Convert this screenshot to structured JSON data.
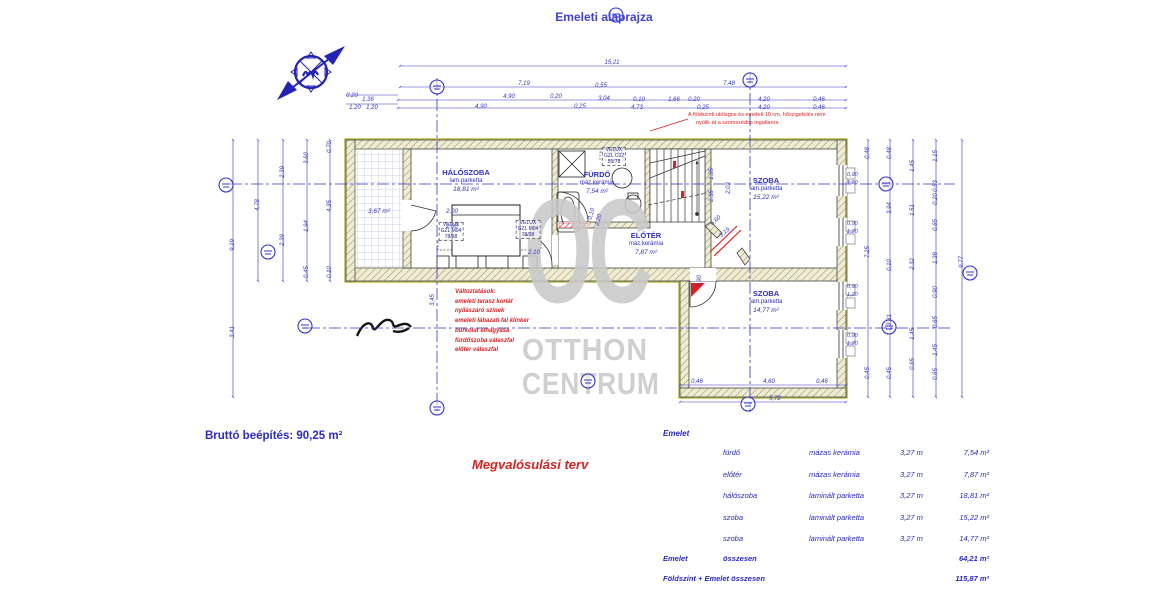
{
  "title": "Emeleti alaprajza",
  "gross_area_label": "Bruttó beépítés: 90,25 m²",
  "plan_type_label": "Megvalósulási terv",
  "insulation_note": [
    "A földszinti utólagos és emeleti 10 cm. hőszigetelés nem",
    "nyúlik át a szomszédos ingatlanra"
  ],
  "changes_note": [
    "Változtatások:",
    "emeleti terasz korlát",
    "nyílászáró színek",
    "emeleti lábazati fal klinker",
    "burkolat elhagyása",
    "fürdőszoba válaszfal",
    "előtér válaszfal"
  ],
  "watermark": {
    "monogram": "OC",
    "name_line1": "OTTHON",
    "name_line2": "CENTRUM"
  },
  "colors": {
    "annotation_blue": "#3434d0",
    "revision_red": "#e02020",
    "watermark_gray": "#c9c9c9",
    "wall_khaki": "#b9b93e"
  },
  "rooms": [
    {
      "name": "HÁLÓSZOBA",
      "floor": "lam.parketta",
      "area": "18,81 m²",
      "x": 466,
      "y": 168
    },
    {
      "name": "FÜRDŐ",
      "floor": "máz.kerámia",
      "area": "7,54 m²",
      "x": 597,
      "y": 170
    },
    {
      "name": "ELŐTÉR",
      "floor": "máz.kerámia",
      "area": "7,87 m²",
      "x": 646,
      "y": 231
    },
    {
      "name": "SZOBA",
      "floor": "lam.parketta",
      "area": "15,22 m²",
      "x": 766,
      "y": 176
    },
    {
      "name": "SZOBA",
      "floor": "lam.parketta",
      "area": "14,77 m²",
      "x": 766,
      "y": 289
    },
    {
      "name": "",
      "floor": "",
      "area": "3,67 m²",
      "x": 379,
      "y": 208
    }
  ],
  "velux": [
    {
      "lines": [
        "VELUX",
        "GZL M04",
        "78/98"
      ],
      "x": 451,
      "y": 222
    },
    {
      "lines": [
        "VELUX",
        "GZL M04",
        "78/98"
      ],
      "x": 528,
      "y": 220
    },
    {
      "lines": [
        "VELUX",
        "GZL C02",
        "55/78"
      ],
      "x": 614,
      "y": 147
    }
  ],
  "window_dims": [
    {
      "top": "0,90",
      "bottom": "1,20",
      "x": 847,
      "y": 172
    },
    {
      "top": "0,90",
      "bottom": "1,20",
      "x": 847,
      "y": 221
    },
    {
      "top": "0,90",
      "bottom": "1,20",
      "x": 847,
      "y": 284
    },
    {
      "top": "0,90",
      "bottom": "1,20",
      "x": 847,
      "y": 333
    }
  ],
  "dims": [
    {
      "t": "15,21",
      "x": 612,
      "y": 63
    },
    {
      "t": "7,19",
      "x": 524,
      "y": 84
    },
    {
      "t": "0,55",
      "x": 601,
      "y": 86
    },
    {
      "t": "7,48",
      "x": 729,
      "y": 84
    },
    {
      "t": "4,90",
      "x": 509,
      "y": 97
    },
    {
      "t": "0,20",
      "x": 556,
      "y": 97
    },
    {
      "t": "3,04",
      "x": 604,
      "y": 99
    },
    {
      "t": "0,10",
      "x": 639,
      "y": 100
    },
    {
      "t": "1,66",
      "x": 674,
      "y": 100
    },
    {
      "t": "0,20",
      "x": 694,
      "y": 100
    },
    {
      "t": "4,20",
      "x": 764,
      "y": 100
    },
    {
      "t": "0,46",
      "x": 819,
      "y": 100
    },
    {
      "t": "4,90",
      "x": 481,
      "y": 107
    },
    {
      "t": "0,25",
      "x": 580,
      "y": 107
    },
    {
      "t": "4,73",
      "x": 637,
      "y": 108
    },
    {
      "t": "0,25",
      "x": 703,
      "y": 108
    },
    {
      "t": "4,20",
      "x": 764,
      "y": 108
    },
    {
      "t": "0,46",
      "x": 819,
      "y": 108
    },
    {
      "t": "0,20",
      "x": 352,
      "y": 96
    },
    {
      "t": "1,36",
      "x": 368,
      "y": 100
    },
    {
      "t": "1,20",
      "x": 355,
      "y": 108
    },
    {
      "t": "1,20",
      "x": 372,
      "y": 108
    },
    {
      "t": "9,19",
      "x": 233,
      "y": 245,
      "r": -90
    },
    {
      "t": "3,41",
      "x": 233,
      "y": 332,
      "r": -90
    },
    {
      "t": "4,78",
      "x": 258,
      "y": 205,
      "r": -90
    },
    {
      "t": "2,39",
      "x": 283,
      "y": 172,
      "r": -90
    },
    {
      "t": "2,39",
      "x": 283,
      "y": 240,
      "r": -90
    },
    {
      "t": "3,60",
      "x": 307,
      "y": 158,
      "r": -90
    },
    {
      "t": "1,94",
      "x": 307,
      "y": 226,
      "r": -90
    },
    {
      "t": "0,45",
      "x": 307,
      "y": 272,
      "r": -90
    },
    {
      "t": "0,70",
      "x": 330,
      "y": 147,
      "r": -90
    },
    {
      "t": "4,35",
      "x": 330,
      "y": 206,
      "r": -90
    },
    {
      "t": "0,10",
      "x": 330,
      "y": 272,
      "r": -90
    },
    {
      "t": "0,48",
      "x": 868,
      "y": 153,
      "r": -90
    },
    {
      "t": "7,25",
      "x": 868,
      "y": 252,
      "r": -90
    },
    {
      "t": "0,45",
      "x": 868,
      "y": 373,
      "r": -90
    },
    {
      "t": "0,48",
      "x": 890,
      "y": 153,
      "r": -90
    },
    {
      "t": "3,94",
      "x": 890,
      "y": 208,
      "r": -90
    },
    {
      "t": "0,10",
      "x": 890,
      "y": 265,
      "r": -90
    },
    {
      "t": "3,31",
      "x": 890,
      "y": 320,
      "r": -90
    },
    {
      "t": "0,45",
      "x": 890,
      "y": 373,
      "r": -90
    },
    {
      "t": "1,45",
      "x": 913,
      "y": 166,
      "r": -90
    },
    {
      "t": "1,51",
      "x": 913,
      "y": 210,
      "r": -90
    },
    {
      "t": "2,32",
      "x": 913,
      "y": 264,
      "r": -90
    },
    {
      "t": "1,45",
      "x": 913,
      "y": 334,
      "r": -90
    },
    {
      "t": "0,65",
      "x": 913,
      "y": 364,
      "r": -90
    },
    {
      "t": "1,15",
      "x": 936,
      "y": 156,
      "r": -90
    },
    {
      "t": "0,53",
      "x": 936,
      "y": 186,
      "r": -90
    },
    {
      "t": "0,20",
      "x": 936,
      "y": 199,
      "r": -90
    },
    {
      "t": "0,65",
      "x": 936,
      "y": 225,
      "r": -90
    },
    {
      "t": "1,38",
      "x": 936,
      "y": 258,
      "r": -90
    },
    {
      "t": "0,90",
      "x": 936,
      "y": 292,
      "r": -90
    },
    {
      "t": "0,65",
      "x": 936,
      "y": 322,
      "r": -90
    },
    {
      "t": "1,45",
      "x": 936,
      "y": 350,
      "r": -90
    },
    {
      "t": "0,65",
      "x": 936,
      "y": 374,
      "r": -90
    },
    {
      "t": "9,77",
      "x": 962,
      "y": 262,
      "r": -90
    },
    {
      "t": "0,46",
      "x": 697,
      "y": 382
    },
    {
      "t": "4,60",
      "x": 769,
      "y": 382
    },
    {
      "t": "0,46",
      "x": 822,
      "y": 382
    },
    {
      "t": "5,72",
      "x": 775,
      "y": 399
    },
    {
      "t": "2,00",
      "x": 452,
      "y": 212
    },
    {
      "t": "2,00",
      "x": 452,
      "y": 227
    },
    {
      "t": "2,10",
      "x": 534,
      "y": 253
    },
    {
      "t": "1,35",
      "x": 712,
      "y": 174,
      "r": -90
    },
    {
      "t": "2,35",
      "x": 712,
      "y": 196,
      "r": -90
    },
    {
      "t": "2,03",
      "x": 729,
      "y": 188,
      "r": -90
    },
    {
      "t": "6,60",
      "x": 716,
      "y": 221,
      "r": -40
    },
    {
      "t": "3,19",
      "x": 725,
      "y": 233,
      "r": -40
    },
    {
      "t": "0,10",
      "x": 592,
      "y": 214,
      "r": -75
    },
    {
      "t": "2,20",
      "x": 599,
      "y": 220,
      "r": -75
    },
    {
      "t": "0,90",
      "x": 700,
      "y": 281,
      "r": -90
    },
    {
      "t": "3,45",
      "x": 433,
      "y": 300,
      "r": -90
    }
  ],
  "table": {
    "header": "Emelet",
    "rows": [
      {
        "name": "fürdő",
        "material": "mázas kerámia",
        "height": "3,27 m",
        "area": "7,54 m²"
      },
      {
        "name": "előtér",
        "material": "mázas kerámia",
        "height": "3,27 m",
        "area": "7,87 m²"
      },
      {
        "name": "hálószoba",
        "material": "laminált parketta",
        "height": "3,27 m",
        "area": "18,81 m²"
      },
      {
        "name": "szoba",
        "material": "laminált parketta",
        "height": "3,27 m",
        "area": "15,22 m²"
      },
      {
        "name": "szoba",
        "material": "laminált parketta",
        "height": "3,27 m",
        "area": "14,77 m²"
      }
    ],
    "totals": [
      {
        "l1": "Emelet",
        "l2": "összesen",
        "v": "64,21 m²"
      },
      {
        "l1": "Földszint + Emelet összesen",
        "l2": "",
        "v": "115,87 m²"
      }
    ]
  }
}
